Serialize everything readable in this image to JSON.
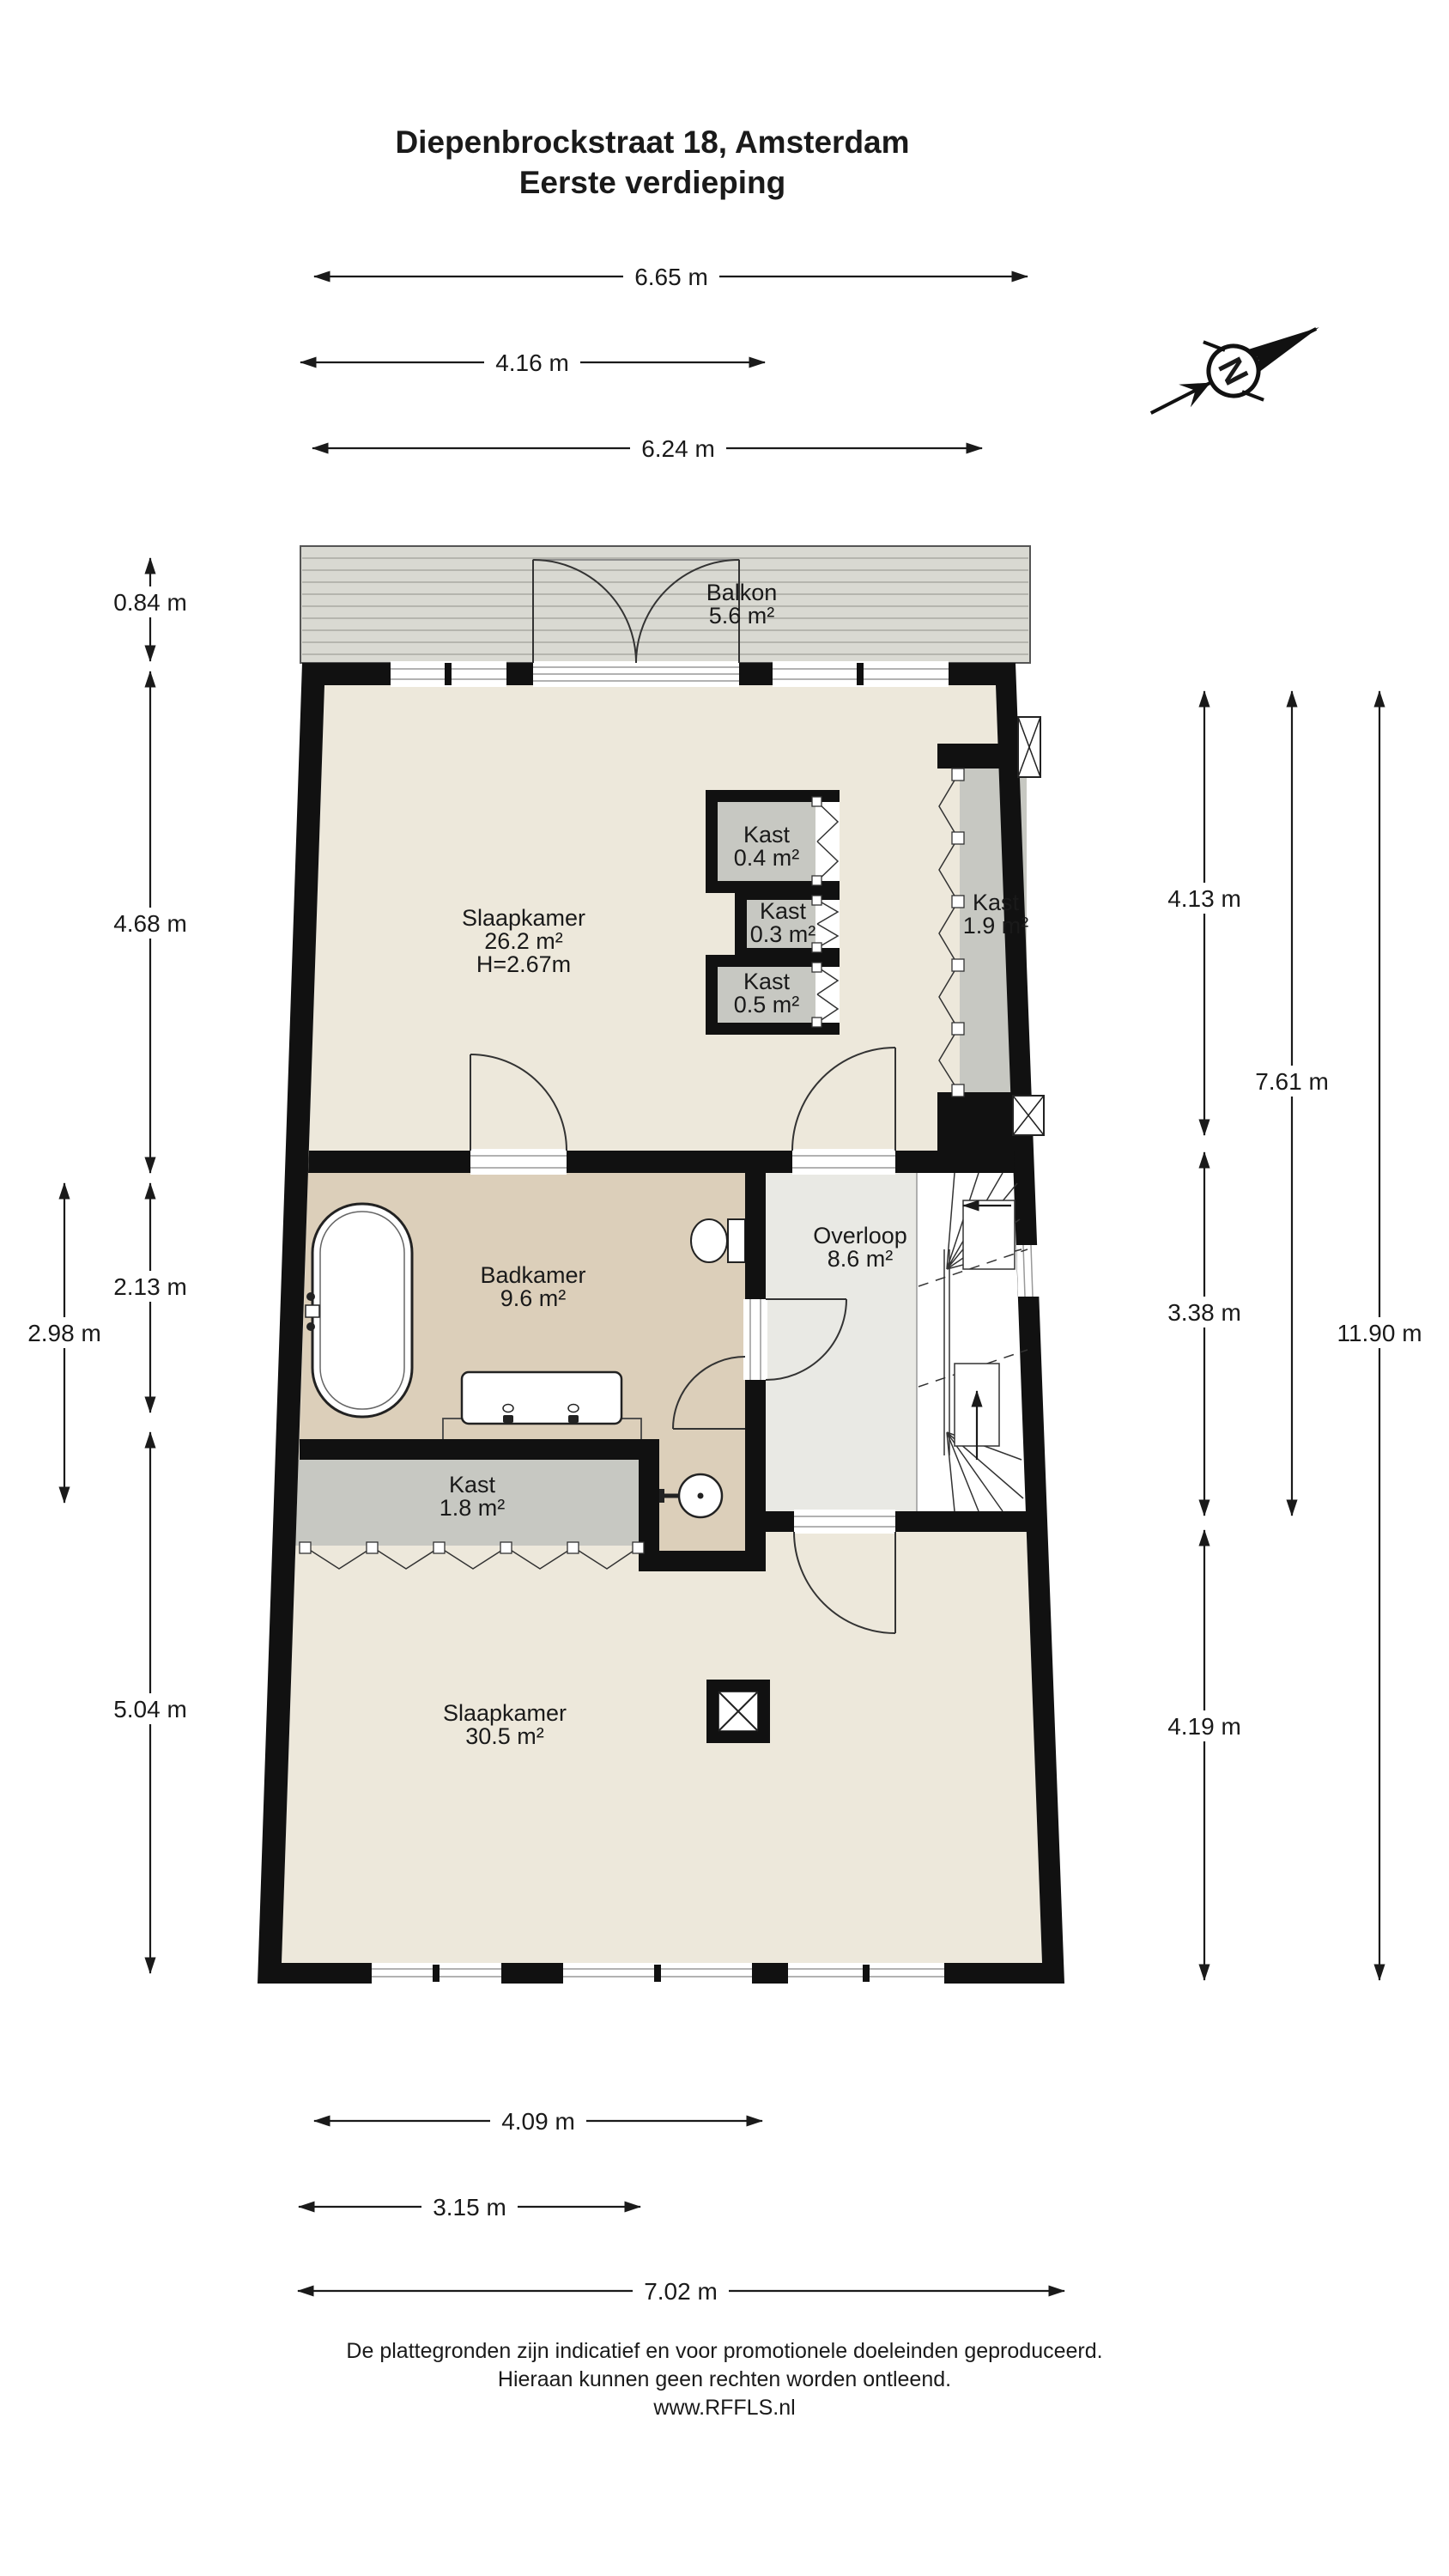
{
  "title": {
    "line1": "Diepenbrockstraat 18, Amsterdam",
    "line2": "Eerste verdieping"
  },
  "compass": {
    "north_label": "N"
  },
  "rooms": {
    "balkon": {
      "name": "Balkon",
      "area": "5.6 m²"
    },
    "slaapkamer_1": {
      "name": "Slaapkamer",
      "area": "26.2 m²",
      "ceiling_height": "H=2.67m"
    },
    "kast_04": {
      "name": "Kast",
      "area": "0.4 m²"
    },
    "kast_03": {
      "name": "Kast",
      "area": "0.3 m²"
    },
    "kast_05": {
      "name": "Kast",
      "area": "0.5 m²"
    },
    "kast_19": {
      "name": "Kast",
      "area": "1.9 m²"
    },
    "badkamer": {
      "name": "Badkamer",
      "area": "9.6 m²"
    },
    "overloop": {
      "name": "Overloop",
      "area": "8.6 m²"
    },
    "kast_18": {
      "name": "Kast",
      "area": "1.8 m²"
    },
    "slaapkamer_2": {
      "name": "Slaapkamer",
      "area": "30.5 m²"
    }
  },
  "dimensions": {
    "top": {
      "d1": "6.65 m",
      "d2": "4.16 m",
      "d3": "6.24 m"
    },
    "left": {
      "d1": "0.84 m",
      "d2": "4.68 m",
      "d3": "2.13 m",
      "d4": "2.98 m",
      "d5": "5.04 m"
    },
    "right": {
      "d1": "4.13 m",
      "d2": "7.61 m",
      "d3": "3.38 m",
      "d4": "11.90 m",
      "d5": "4.19 m"
    },
    "bottom": {
      "d1": "4.09 m",
      "d2": "3.15 m",
      "d3": "7.02 m"
    }
  },
  "footer": {
    "line1": "De plattegronden zijn indicatief en voor promotionele doeleinden geproduceerd.",
    "line2": "Hieraan kunnen geen rechten worden ontleend.",
    "line3": "www.RFFLS.nl"
  },
  "colors": {
    "wall": "#111111",
    "room_cream": "#EDE8DB",
    "bathroom_tan": "#DCCFBA",
    "closet_gray": "#C7C8C2",
    "landing_gray": "#E9E9E4",
    "balcony_gray": "#D9D9D2"
  }
}
